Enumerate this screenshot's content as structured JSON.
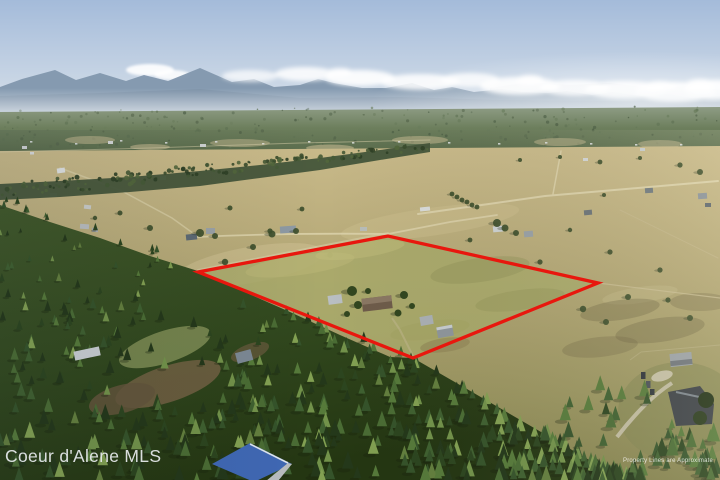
{
  "photo": {
    "watermark": "Coeur d'Alene MLS",
    "disclaimer": "Property Lines are Approximate"
  },
  "boundary": {
    "points": "198,272 388,236 598,283 413,358",
    "color": "#e8170e"
  },
  "palette": {
    "sky": "#a8bedb",
    "mountain": "#8297ae",
    "distant_forest": "#64754f",
    "valley_field": "#b6a877",
    "property_field": "#a8a96a",
    "forest_dark": "#2c421c",
    "blue_roof": "#4068b4",
    "watermark_text": "#e9edef"
  }
}
